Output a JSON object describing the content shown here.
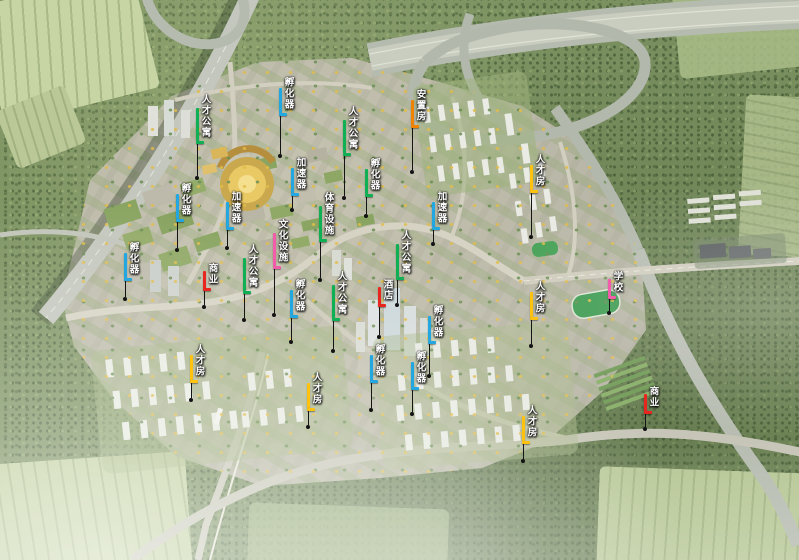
{
  "map": {
    "annotation_colors": {
      "blue": "#22A7E0",
      "green": "#0FAF54",
      "yellow": "#FFC20E",
      "orange": "#F08300",
      "red": "#E8251F",
      "pink": "#F25CA8"
    },
    "labels": [
      {
        "text": "人才公寓",
        "color": "green",
        "x": 196,
        "y": 94,
        "leader": 32
      },
      {
        "text": "孵化器",
        "color": "blue",
        "x": 279,
        "y": 77,
        "leader": 38
      },
      {
        "text": "人才公寓",
        "color": "green",
        "x": 343,
        "y": 106,
        "leader": 40
      },
      {
        "text": "安置房",
        "color": "orange",
        "x": 411,
        "y": 89,
        "leader": 42
      },
      {
        "text": "人才房",
        "color": "yellow",
        "x": 530,
        "y": 154,
        "leader": 42
      },
      {
        "text": "加速器",
        "color": "blue",
        "x": 291,
        "y": 157,
        "leader": 12
      },
      {
        "text": "孵化器",
        "color": "green",
        "x": 365,
        "y": 158,
        "leader": 17
      },
      {
        "text": "孵化器",
        "color": "blue",
        "x": 176,
        "y": 183,
        "leader": 26
      },
      {
        "text": "加速器",
        "color": "blue",
        "x": 226,
        "y": 191,
        "leader": 16
      },
      {
        "text": "体育设施",
        "color": "green",
        "x": 319,
        "y": 192,
        "leader": 36
      },
      {
        "text": "文化设施",
        "color": "pink",
        "x": 273,
        "y": 219,
        "leader": 44
      },
      {
        "text": "加速器",
        "color": "blue",
        "x": 432,
        "y": 191,
        "leader": 12
      },
      {
        "text": "孵化器",
        "color": "blue",
        "x": 124,
        "y": 242,
        "leader": 16
      },
      {
        "text": "人才公寓",
        "color": "green",
        "x": 243,
        "y": 244,
        "leader": 24
      },
      {
        "text": "商业",
        "color": "red",
        "x": 203,
        "y": 263,
        "leader": 14
      },
      {
        "text": "人才公寓",
        "color": "green",
        "x": 396,
        "y": 230,
        "leader": 23
      },
      {
        "text": "学校",
        "color": "pink",
        "x": 608,
        "y": 271,
        "leader": 12
      },
      {
        "text": "人才房",
        "color": "yellow",
        "x": 530,
        "y": 281,
        "leader": 24
      },
      {
        "text": "人才公寓",
        "color": "green",
        "x": 332,
        "y": 271,
        "leader": 28
      },
      {
        "text": "酒店",
        "color": "red",
        "x": 378,
        "y": 279,
        "leader": 28
      },
      {
        "text": "孵化器",
        "color": "blue",
        "x": 428,
        "y": 305,
        "leader": 30
      },
      {
        "text": "孵化器",
        "color": "blue",
        "x": 290,
        "y": 279,
        "leader": 22
      },
      {
        "text": "孵化器",
        "color": "blue",
        "x": 370,
        "y": 344,
        "leader": 25
      },
      {
        "text": "孵化器",
        "color": "blue",
        "x": 411,
        "y": 351,
        "leader": 22
      },
      {
        "text": "人才房",
        "color": "yellow",
        "x": 190,
        "y": 344,
        "leader": 15
      },
      {
        "text": "人才房",
        "color": "yellow",
        "x": 307,
        "y": 372,
        "leader": 14
      },
      {
        "text": "人才房",
        "color": "yellow",
        "x": 522,
        "y": 405,
        "leader": 15
      },
      {
        "text": "商业",
        "color": "red",
        "x": 644,
        "y": 386,
        "leader": 13
      }
    ]
  }
}
